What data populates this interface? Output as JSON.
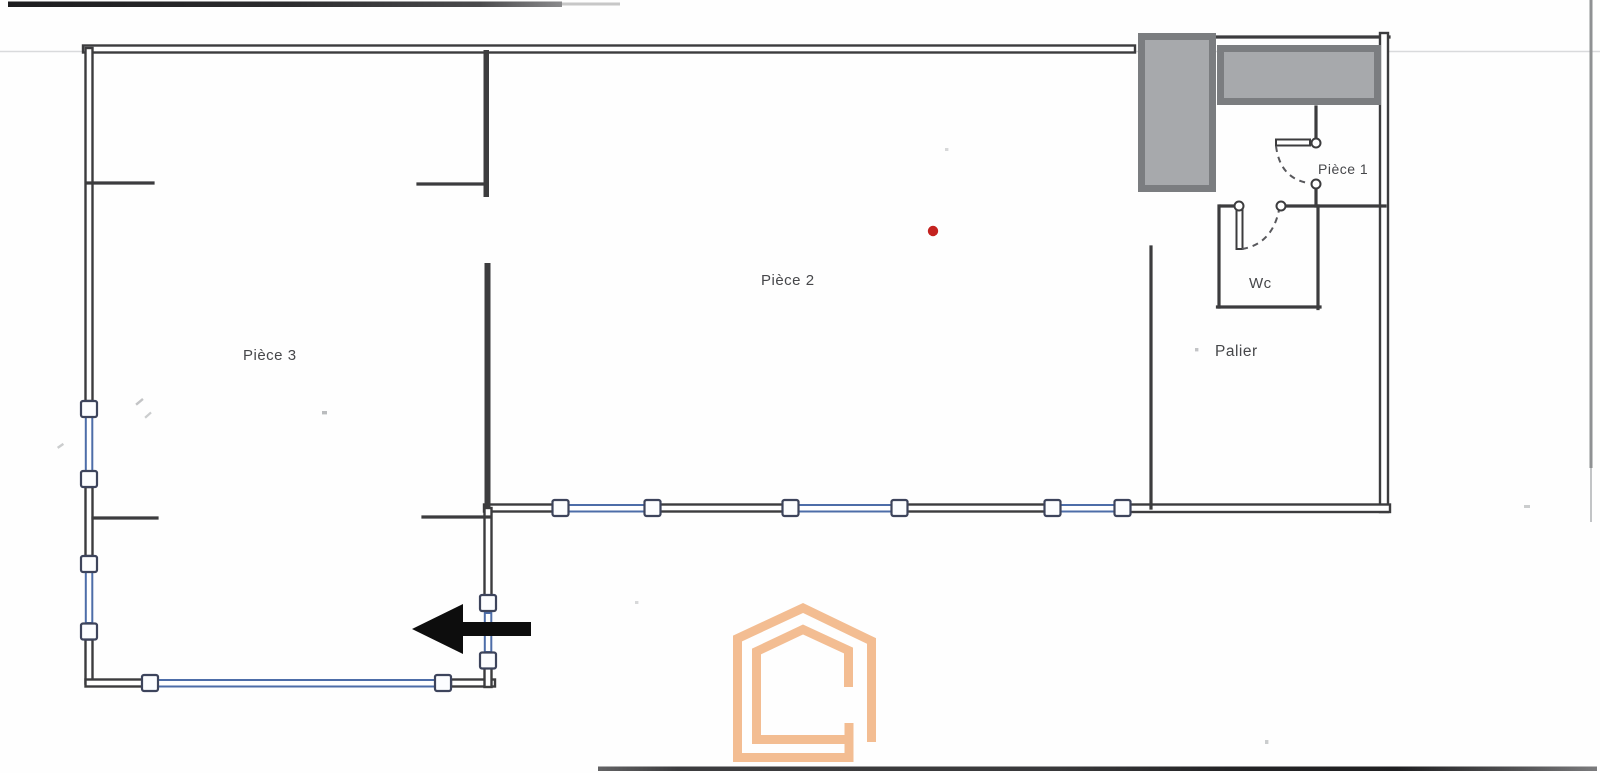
{
  "document": {
    "kind": "scanned floor plan",
    "language": "French"
  },
  "rooms": {
    "piece3": "Pièce 3",
    "piece2": "Pièce 2",
    "piece1": "Pièce 1",
    "wc": "Wc",
    "palier": "Palier"
  },
  "markers": {
    "red_dot": "red position marker in Pièce 2",
    "entrance_arrow": "black arrow pointing left through lower wall",
    "watermark": "orange nested house-outline logo"
  },
  "colors": {
    "paper": "#fefefe",
    "wall": "#3c3c3e",
    "window-frame": "#4d6da8",
    "window-square-border": "#3d445c",
    "gray-block-fill": "#a7a9ac",
    "gray-block-border": "#7b7d80",
    "red-marker": "#c4221f",
    "logo-orange": "#f3bd92",
    "arrow-black": "#0d0d0d",
    "label-text": "#46474a",
    "scan-dark": "#2a2a2c",
    "scan-faint": "#d9dadc"
  }
}
